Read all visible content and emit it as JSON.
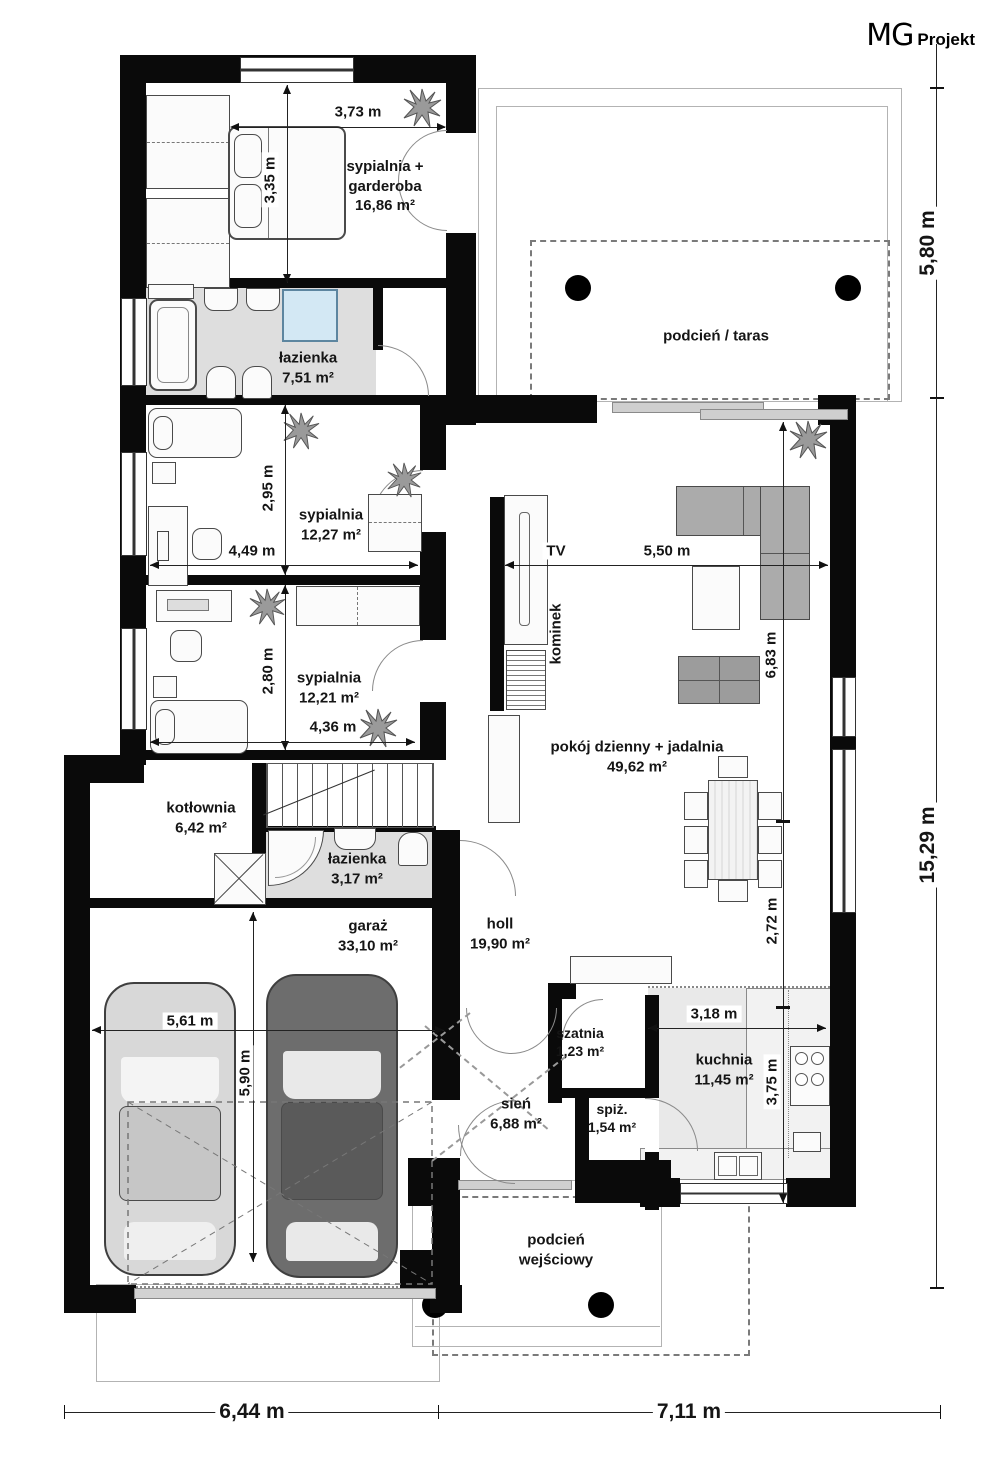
{
  "logo": {
    "mg": "MG",
    "projekt": "Projekt"
  },
  "rooms": {
    "master": {
      "line1": "sypialnia +",
      "line2": "garderoba",
      "area": "16,86 m²"
    },
    "bath_main": {
      "name": "łazienka",
      "area": "7,51 m²"
    },
    "bed2": {
      "name": "sypialnia",
      "area": "12,27 m²"
    },
    "bed3": {
      "name": "sypialnia",
      "area": "12,21 m²"
    },
    "boiler": {
      "name": "kotłownia",
      "area": "6,42 m²"
    },
    "bath_small": {
      "name": "łazienka",
      "area": "3,17 m²"
    },
    "garage": {
      "name": "garaż",
      "area": "33,10 m²"
    },
    "hall": {
      "name": "holl",
      "area": "19,90 m²"
    },
    "living": {
      "name": "pokój dzienny + jadalnia",
      "area": "49,62 m²"
    },
    "kitchen": {
      "name": "kuchnia",
      "area": "11,45 m²"
    },
    "cloak": {
      "name": "szatnia",
      "area": "1,23 m²"
    },
    "pantry": {
      "name": "spiż.",
      "area": "1,54 m²"
    },
    "vestibule": {
      "name": "sień",
      "area": "6,88 m²"
    },
    "terrace": {
      "name": "podcień / taras"
    },
    "porch": {
      "line1": "podcień",
      "line2": "wejściowy"
    },
    "tv_label": "TV",
    "fireplace_label": "kominek"
  },
  "dims": {
    "d373": "3,73 m",
    "d335": "3,35 m",
    "d580": "5,80 m",
    "d295": "2,95 m",
    "d449": "4,49 m",
    "d280": "2,80 m",
    "d436": "4,36 m",
    "d550": "5,50 m",
    "d683": "6,83 m",
    "d272": "2,72 m",
    "d561": "5,61 m",
    "d590": "5,90 m",
    "d318": "3,18 m",
    "d375": "3,75 m",
    "d1529": "15,29 m",
    "d644": "6,44 m",
    "d711": "7,11 m"
  }
}
